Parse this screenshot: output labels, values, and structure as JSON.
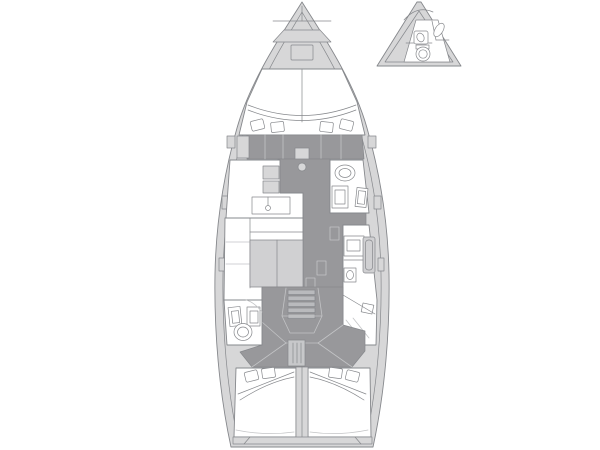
{
  "canvas": {
    "width": 600,
    "height": 450
  },
  "palette": {
    "background": "#ffffff",
    "deck": "#d7d7d8",
    "floor": "#98989b",
    "furniture": "#d0d0d2",
    "panel": "#c7c8ca",
    "step": "#b9babd",
    "white": "#ffffff",
    "line": "#86888c",
    "line_light": "#c3c4c6"
  },
  "diagram": {
    "kind": "sailing-yacht-interior-floorplan",
    "orientation": "bow-up",
    "views": [
      {
        "id": "main-hull-plan",
        "features": [
          "bow-anchor-locker",
          "foredeck-hatch",
          "forward-cabin-vberth",
          "berth-pillows",
          "wardrobe-lockers",
          "mast-step",
          "forward-head-toilet",
          "forward-head-basins",
          "chart-table",
          "saloon-settee",
          "saloon-table",
          "galley-counter",
          "galley-stove",
          "galley-sink",
          "companionway-stairs",
          "helm-console",
          "aft-head-toilet",
          "aft-head-basins",
          "cockpit",
          "aft-cabin-port-berth",
          "aft-cabin-starboard-berth",
          "transom-platform"
        ]
      },
      {
        "id": "bow-option-inset",
        "features": [
          "bow-wc-toilet",
          "bow-wc-basin",
          "bow-wc-shower-tray"
        ]
      }
    ]
  }
}
